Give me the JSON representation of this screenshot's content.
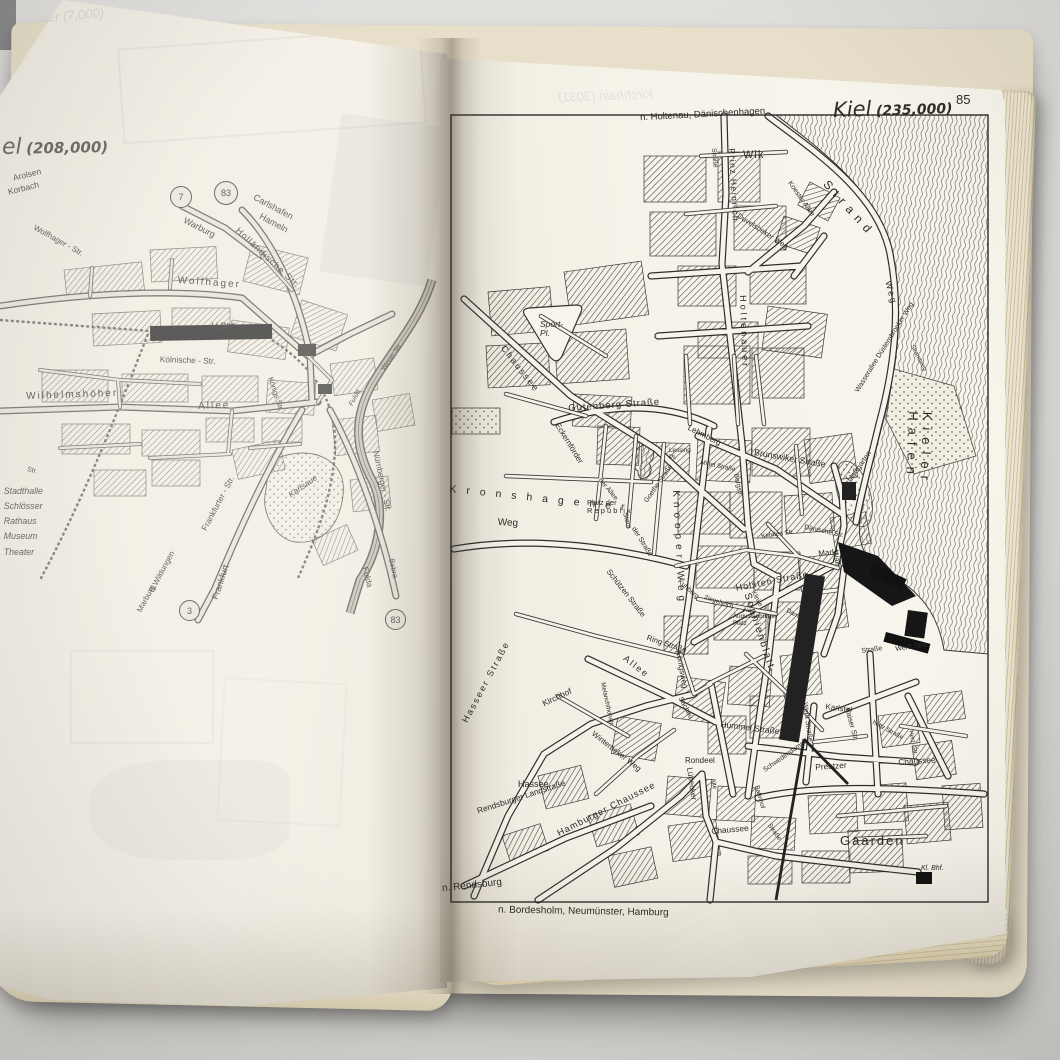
{
  "photo_subject": "open vintage road atlas showing city maps of Kassel and Kiel",
  "colors": {
    "page": "#f6f3ea",
    "ink": "#2b2a26",
    "page_edges": "#d6caa9",
    "background": "#dcdad7"
  },
  "left_page": {
    "title_fragment": "el",
    "population": "(208,000)",
    "bleed_text": "ever (7,000)",
    "route_badges": [
      "7",
      "83",
      "3",
      "83"
    ],
    "legend": [
      "1. Stadthalle",
      "2. Schlösser",
      "3. Rathaus",
      "4. Museum",
      "5. Theater"
    ],
    "labels": [
      {
        "t": "Arolsen",
        "x": 12,
        "y": 174,
        "r": -14,
        "s": 8.5
      },
      {
        "t": "Korbach",
        "x": 7,
        "y": 188,
        "r": -14,
        "s": 8.5
      },
      {
        "t": "Carlshafen",
        "x": 256,
        "y": 193,
        "r": 28,
        "s": 9
      },
      {
        "t": "Hameln",
        "x": 262,
        "y": 212,
        "r": 28,
        "s": 9
      },
      {
        "t": "Warburg",
        "x": 186,
        "y": 216,
        "r": 27,
        "s": 9
      },
      {
        "t": "Holländische Str.",
        "x": 240,
        "y": 226,
        "r": 43,
        "s": 9,
        "ls": 1
      },
      {
        "t": "Wolfhager - Str.",
        "x": 36,
        "y": 224,
        "r": 29,
        "s": 8
      },
      {
        "t": "Wolfhager",
        "x": 178,
        "y": 276,
        "r": 4,
        "s": 10,
        "ls": 2
      },
      {
        "t": "H.Bhf.",
        "x": 211,
        "y": 322,
        "s": 9,
        "i": 1
      },
      {
        "t": "Kölnische - Str.",
        "x": 160,
        "y": 355,
        "r": 2,
        "s": 8.3
      },
      {
        "t": "Königs Str.",
        "x": 274,
        "y": 376,
        "r": 72,
        "s": 7.3
      },
      {
        "t": "Weser-Str.",
        "x": 380,
        "y": 368,
        "r": -55,
        "s": 6.8
      },
      {
        "t": "Fulda",
        "x": 348,
        "y": 404,
        "r": -62,
        "s": 7,
        "i": 1
      },
      {
        "t": "Wilhelmshöher",
        "x": 26,
        "y": 392,
        "r": -2,
        "s": 10,
        "ls": 2
      },
      {
        "t": "Allee",
        "x": 198,
        "y": 402,
        "r": -2,
        "s": 10,
        "ls": 2
      },
      {
        "t": "Str.",
        "x": 28,
        "y": 466,
        "r": 15,
        "s": 7
      },
      {
        "t": "Frankfurter - Str.",
        "x": 200,
        "y": 528,
        "r": -62,
        "s": 8.3
      },
      {
        "t": "Frankfurt",
        "x": 211,
        "y": 598,
        "r": -72,
        "s": 9
      },
      {
        "t": "Karlsaue",
        "x": 287,
        "y": 492,
        "r": -35,
        "s": 8.3,
        "i": 1
      },
      {
        "t": "Nürnberger - Str.",
        "x": 380,
        "y": 450,
        "r": 78,
        "s": 8.3
      },
      {
        "t": "Fulda",
        "x": 369,
        "y": 566,
        "r": 75,
        "s": 8.3
      },
      {
        "t": "Bebra",
        "x": 395,
        "y": 558,
        "r": 78,
        "s": 7.3
      },
      {
        "t": "B.Wildungen",
        "x": 148,
        "y": 590,
        "r": -62,
        "s": 8
      },
      {
        "t": "Marburg",
        "x": 136,
        "y": 610,
        "r": -62,
        "s": 8
      }
    ]
  },
  "right_page": {
    "page_number": "85",
    "title": "Kiel",
    "population": "(235,000)",
    "top_margin_label": "n. Holtenau, Dänischenhagen",
    "bottom_margin_labels": [
      "n. Rendsburg",
      "n. Bordesholm, Neumünster, Hamburg"
    ],
    "bleed_text": "Kirchhain (3031)",
    "labels": [
      {
        "t": "Wik",
        "x": 303,
        "y": 98,
        "s": 11,
        "ls": 1
      },
      {
        "t": "Straße",
        "x": 276,
        "y": 96,
        "r": 85,
        "s": 6.5
      },
      {
        "t": "Prinz Heinrich",
        "x": 296,
        "y": 96,
        "r": 87,
        "s": 8.5,
        "ls": 1.5
      },
      {
        "t": "Holtenauer",
        "x": 307,
        "y": 243,
        "r": 88,
        "s": 9,
        "ls": 3
      },
      {
        "t": "Duvelsbeker Weg",
        "x": 300,
        "y": 160,
        "r": 33,
        "s": 7.5
      },
      {
        "t": "Koester Allee",
        "x": 352,
        "y": 128,
        "r": 55,
        "s": 7
      },
      {
        "t": "Strand",
        "x": 390,
        "y": 126,
        "r": 48,
        "s": 12,
        "ls": 6
      },
      {
        "t": "Weg",
        "x": 452,
        "y": 228,
        "r": 75,
        "s": 9,
        "ls": 2
      },
      {
        "t": "Strandweg",
        "x": 474,
        "y": 292,
        "r": 62,
        "s": 6
      },
      {
        "t": "Kieler Hafen",
        "x": 494,
        "y": 360,
        "r": 92,
        "s": 13,
        "ls": 7
      },
      {
        "t": "Sport-\nPl.",
        "x": 100,
        "y": 268,
        "s": 8.5,
        "i": 1
      },
      {
        "t": "Chaussee",
        "x": 66,
        "y": 292,
        "r": 52,
        "s": 9,
        "ls": 2
      },
      {
        "t": "Eckernförder",
        "x": 120,
        "y": 370,
        "r": 58,
        "s": 8
      },
      {
        "t": "der Straße",
        "x": 196,
        "y": 474,
        "r": 58,
        "s": 7
      },
      {
        "t": "Gutenberg Straße",
        "x": 128,
        "y": 352,
        "r": -4,
        "s": 9.5,
        "ls": 1
      },
      {
        "t": "Lehmberg",
        "x": 250,
        "y": 372,
        "r": 27,
        "s": 8
      },
      {
        "t": "Lessing\nPl.",
        "x": 229,
        "y": 396,
        "s": 6.3
      },
      {
        "t": "Mittel Straße",
        "x": 261,
        "y": 408,
        "r": 12,
        "s": 6.3
      },
      {
        "t": "Goethe Straße",
        "x": 203,
        "y": 448,
        "r": -55,
        "s": 6.8
      },
      {
        "t": "Brunswiker Straße",
        "x": 315,
        "y": 396,
        "r": 10,
        "s": 8.8
      },
      {
        "t": "Knooper Weg",
        "x": 240,
        "y": 438,
        "r": 87,
        "s": 10,
        "ls": 5
      },
      {
        "t": "Bergstr.",
        "x": 299,
        "y": 421,
        "r": 78,
        "s": 6.8
      },
      {
        "t": "Kehden Str.",
        "x": 321,
        "y": 482,
        "r": -8,
        "s": 6.3
      },
      {
        "t": "Dänische Str.",
        "x": 365,
        "y": 472,
        "r": 12,
        "s": 6.8
      },
      {
        "t": "Markt",
        "x": 378,
        "y": 498,
        "r": -5,
        "s": 8
      },
      {
        "t": "Schloßgarten",
        "x": 401,
        "y": 434,
        "r": -55,
        "s": 7.5
      },
      {
        "t": "Wasserallee Düsternbrooker Weg",
        "x": 414,
        "y": 338,
        "r": -58,
        "s": 7
      },
      {
        "t": "Wall",
        "x": 399,
        "y": 498,
        "r": 80,
        "s": 7.5
      },
      {
        "t": "Holsten Straße",
        "x": 295,
        "y": 532,
        "r": -11,
        "s": 9,
        "ls": 1
      },
      {
        "t": "Kuhberg",
        "x": 241,
        "y": 526,
        "r": 42,
        "s": 6.8
      },
      {
        "t": "Ziegelteich",
        "x": 265,
        "y": 543,
        "r": 18,
        "s": 6.3
      },
      {
        "t": "Au",
        "x": 303,
        "y": 556,
        "s": 6.3
      },
      {
        "t": "Klinke",
        "x": 315,
        "y": 538,
        "r": 62,
        "s": 6.3
      },
      {
        "t": "Damm",
        "x": 348,
        "y": 556,
        "r": 30,
        "s": 6.3
      },
      {
        "t": "Augustenburger\nPlatz",
        "x": 293,
        "y": 562,
        "s": 6.2
      },
      {
        "t": "Kronshagener",
        "x": 10,
        "y": 432,
        "r": 6,
        "s": 10.5,
        "ls": 10
      },
      {
        "t": "Weg",
        "x": 58,
        "y": 466,
        "r": 3,
        "s": 10
      },
      {
        "t": "Platz der\nR e p u b l i k",
        "x": 147,
        "y": 447,
        "s": 7.5
      },
      {
        "t": "der Allee",
        "x": 162,
        "y": 425,
        "r": 50,
        "s": 6.8
      },
      {
        "t": "Stern",
        "x": 188,
        "y": 460,
        "r": 75,
        "s": 6.8
      },
      {
        "t": "Schützen Straße",
        "x": 171,
        "y": 516,
        "r": 52,
        "s": 7.8
      },
      {
        "t": "Ring Straße",
        "x": 208,
        "y": 582,
        "r": 18,
        "s": 7.8
      },
      {
        "t": "Allee",
        "x": 187,
        "y": 602,
        "r": 38,
        "s": 9,
        "ls": 2
      },
      {
        "t": "Königsweg",
        "x": 242,
        "y": 598,
        "r": 80,
        "s": 7.8
      },
      {
        "t": "Sachau",
        "x": 243,
        "y": 644,
        "r": 62,
        "s": 7
      },
      {
        "t": "Sophienblatt",
        "x": 311,
        "y": 540,
        "r": 72,
        "s": 10,
        "ls": 2
      },
      {
        "t": "Hummel Straße",
        "x": 281,
        "y": 668,
        "r": 7,
        "s": 8.5
      },
      {
        "t": "Kirchhof",
        "x": 101,
        "y": 648,
        "r": -25,
        "s": 8.5
      },
      {
        "t": "Melanchthonstr.",
        "x": 165,
        "y": 630,
        "r": 78,
        "s": 6.3
      },
      {
        "t": "Winterbeker Weg",
        "x": 155,
        "y": 678,
        "r": 38,
        "s": 7.8
      },
      {
        "t": "Hasseer Straße",
        "x": 21,
        "y": 668,
        "r": -62,
        "s": 9,
        "ls": 2
      },
      {
        "t": "Hassee",
        "x": 78,
        "y": 728,
        "s": 9
      },
      {
        "t": "Rendsburger Landstraße",
        "x": 36,
        "y": 755,
        "r": -18,
        "s": 8.3
      },
      {
        "t": "Hamburger Chaussee",
        "x": 116,
        "y": 778,
        "r": -27,
        "s": 9.3,
        "ls": 1
      },
      {
        "t": "Rondeel",
        "x": 245,
        "y": 705,
        "s": 8
      },
      {
        "t": "Lübecker",
        "x": 253,
        "y": 715,
        "r": 82,
        "s": 8
      },
      {
        "t": "Chaussee",
        "x": 271,
        "y": 775,
        "r": -5,
        "s": 8.3
      },
      {
        "t": "Alte",
        "x": 275,
        "y": 726,
        "r": 78,
        "s": 6.3
      },
      {
        "t": "Bahnhof",
        "x": 319,
        "y": 733,
        "r": 75,
        "s": 6.3
      },
      {
        "t": "Schwedendamm",
        "x": 322,
        "y": 716,
        "r": -35,
        "s": 6.8
      },
      {
        "t": "Straße",
        "x": 331,
        "y": 771,
        "r": 55,
        "s": 6.3
      },
      {
        "t": "Preetzer",
        "x": 375,
        "y": 711,
        "r": -4,
        "s": 8.3
      },
      {
        "t": "Chaussee",
        "x": 458,
        "y": 706,
        "r": -4,
        "s": 8.3
      },
      {
        "t": "Gaarden",
        "x": 400,
        "y": 782,
        "s": 13,
        "ls": 2
      },
      {
        "t": "Kaiser Str.",
        "x": 411,
        "y": 655,
        "r": 75,
        "s": 7.3
      },
      {
        "t": "Karlstal",
        "x": 386,
        "y": 651,
        "r": 8,
        "s": 8
      },
      {
        "t": "holtz Straße",
        "x": 434,
        "y": 668,
        "r": 28,
        "s": 6.3
      },
      {
        "t": "Herz. Str.",
        "x": 473,
        "y": 678,
        "r": 78,
        "s": 6
      },
      {
        "t": "Werft Straße",
        "x": 368,
        "y": 650,
        "r": 82,
        "s": 7
      },
      {
        "t": "Werft Stra.",
        "x": 455,
        "y": 594,
        "r": -8,
        "s": 7
      },
      {
        "t": "Straße",
        "x": 421,
        "y": 596,
        "r": -8,
        "s": 7
      },
      {
        "t": "Kl. Bhf.",
        "x": 481,
        "y": 813,
        "s": 7,
        "i": 1
      }
    ]
  }
}
